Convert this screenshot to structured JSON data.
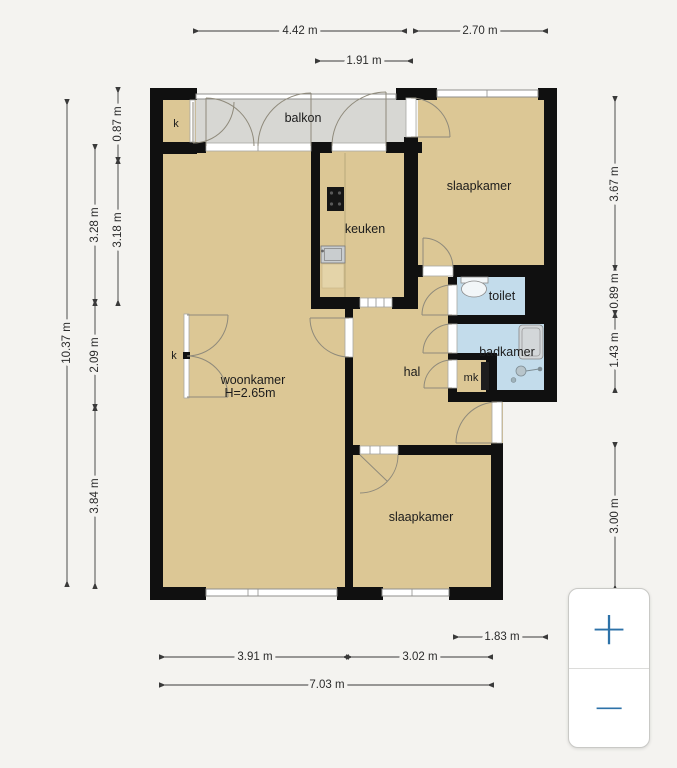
{
  "plan": {
    "rooms": {
      "balkon": "balkon",
      "slaapkamer_top": "slaapkamer",
      "keuken": "keuken",
      "toilet": "toilet",
      "badkamer": "badkamer",
      "woonkamer": "woonkamer",
      "woonkamer_height": "H=2.65m",
      "hal": "hal",
      "mk": "mk",
      "slaapkamer_bottom": "slaapkamer",
      "closet_top": "k",
      "closet_mid": "k"
    },
    "dimensions": {
      "top": [
        "4.42 m",
        "2.70 m",
        "1.91 m"
      ],
      "bottom": [
        "1.83 m",
        "3.91 m",
        "3.02 m",
        "7.03 m"
      ],
      "left": [
        "10.37 m",
        "0.87 m",
        "3.28 m",
        "3.18 m",
        "2.09 m",
        "3.84 m"
      ],
      "right": [
        "3.67 m",
        "0.89 m",
        "1.43 m",
        "3.00 m"
      ]
    },
    "colors": {
      "wall": "#101010",
      "floor_tan": "#dcc795",
      "floor_balcony": "#d7d7d3",
      "floor_wet": "#c3dceb",
      "background": "#f4f3f0",
      "accent_blue": "#2d72a8"
    }
  },
  "zoom_controls": {
    "zoom_in": "+",
    "zoom_out": "−"
  }
}
